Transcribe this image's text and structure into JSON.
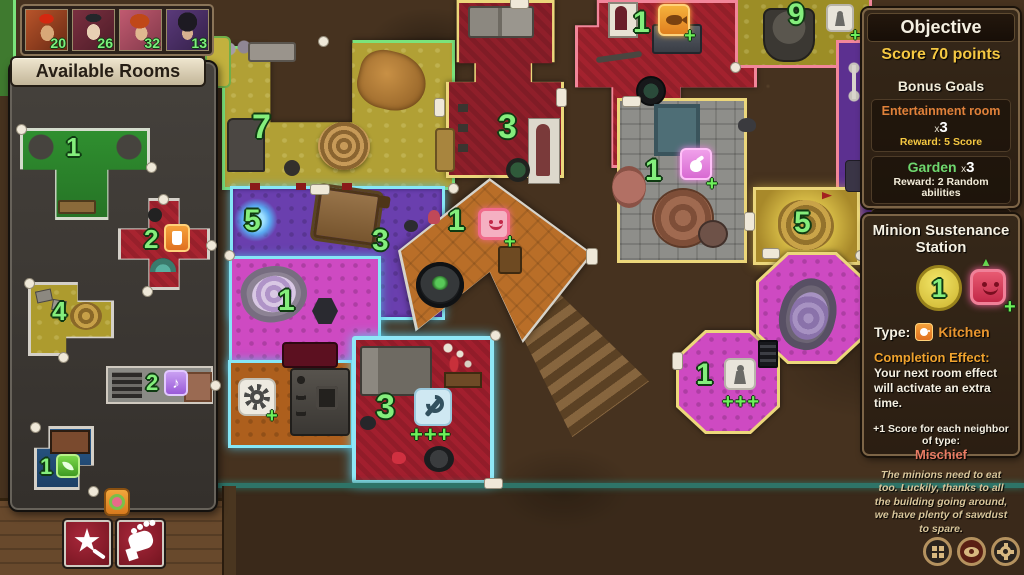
{
  "hud": {
    "players": [
      {
        "score": "20"
      },
      {
        "score": "26"
      },
      {
        "score": "32"
      },
      {
        "score": "13"
      }
    ]
  },
  "left_panel": {
    "title": "Available Rooms",
    "cards": {
      "garden_t": {
        "count": "1"
      },
      "red_cross": {
        "count": "2"
      },
      "gold_l": {
        "count": "4"
      },
      "entertainment_bar": {
        "count": "2"
      },
      "garden_blue": {
        "count": "1"
      }
    }
  },
  "map": {
    "lounge": {
      "count": "7"
    },
    "armory": {
      "count": "3"
    },
    "kitchen": {
      "count": "1",
      "plus": "+"
    },
    "quarters": {
      "count": "9",
      "plus": "+"
    },
    "lab": {
      "count": "1",
      "plus": "+"
    },
    "treasury": {
      "count": "5"
    },
    "club": {
      "count": "5"
    },
    "club_table": {
      "count": "3"
    },
    "geode_room": {
      "count": "1"
    },
    "mischief_room": {
      "count": "1",
      "plus": "+"
    },
    "machine_room": {
      "plus": "+"
    },
    "workshop": {
      "count": "3",
      "plus": "+++"
    },
    "walkway": {
      "count": "1",
      "plus": "+++"
    }
  },
  "objective": {
    "title": "Objective",
    "main_goal": "Score 70 points",
    "bonus_title": "Bonus Goals",
    "goals": [
      {
        "name": "Entertainment room",
        "x": "x",
        "n": "3",
        "reward": "Reward: 5 Score",
        "color": "#e0813a"
      },
      {
        "name": "Garden",
        "x": "x",
        "n": "3",
        "reward": "Reward: 2 Random abilities",
        "color": "#6ed86e"
      },
      {
        "name": "Sabotage room",
        "x": "x",
        "n": "3",
        "reward": "Reward: 5 Score",
        "color": "#9b948a"
      }
    ]
  },
  "station": {
    "title": "Minion Sustenance Station",
    "count": "1",
    "triangle": "▲",
    "plus": "+",
    "type_label": "Type:",
    "type_value": "Kitchen",
    "effect_label": "Completion Effect:",
    "effect_text": "Your next room effect will activate an extra time.",
    "neighbor_label": "+1 Score for each neighbor of type:",
    "neighbor_value": "Mischief",
    "flavor": "The minions need to eat too. Luckily, thanks to all the building going around, we have plenty of sawdust to spare."
  }
}
